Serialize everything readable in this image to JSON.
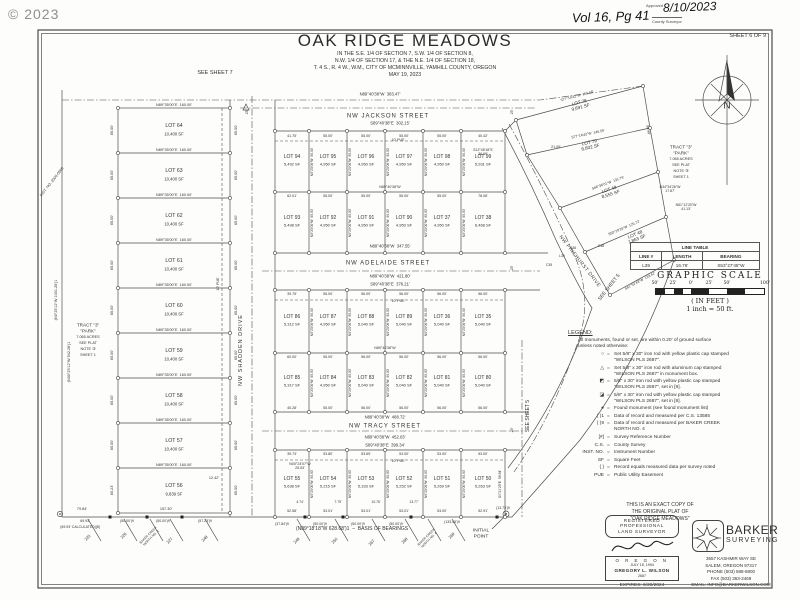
{
  "meta": {
    "copyright": "© 2023",
    "sheet": "SHEET 6 OF 9",
    "vol": "Vol 16, Pg 41",
    "approved_label": "Approved",
    "approved_date": "8/10/2023",
    "county": "County Surveyor"
  },
  "title": {
    "main": "OAK RIDGE MEADOWS",
    "sub1": "IN THE S.E. 1/4 OF SECTION 7, S.W. 1/4 OF SECTION 8,",
    "sub2": "N.W. 1/4 OF SECTION 17, & THE N.E. 1/4 OF SECTION 18,",
    "sub3": "T. 4 S., R. 4 W., W.M., CITY OF MCMINNVILLE, YAMHILL  COUNTY, OREGON",
    "date": "MAY 19, 2023"
  },
  "refs": {
    "see_sheet_7": "SEE SHEET 7",
    "see_sheet_5": "SEE SHEET 5",
    "north": "N"
  },
  "streets": {
    "jackson": "NW JACKSON STREET",
    "adelaide": "NW ADELAIDE STREET",
    "tracy": "NW TRACY STREET",
    "shadden": "NW SHADDEN DRIVE",
    "pinehurst": "NW PINEHURST DRIVE"
  },
  "left_column": {
    "divider_bearing": "N89°35'00\"E  160.00'",
    "side_dim": "65.00'",
    "pue": "10' PUE",
    "lots": [
      [
        "LOT 64",
        "10,400 SF"
      ],
      [
        "LOT 63",
        "10,400 SF"
      ],
      [
        "LOT 62",
        "10,400 SF"
      ],
      [
        "LOT 61",
        "10,400 SF"
      ],
      [
        "LOT 60",
        "10,400 SF"
      ],
      [
        "LOT 59",
        "10,400 SF"
      ],
      [
        "LOT 58",
        "10,400 SF"
      ],
      [
        "LOT 57",
        "10,400 SF"
      ],
      [
        "LOT 56",
        "9,839 SF"
      ]
    ],
    "edge_bearing1": "(N0°25'12\"W 1001.26')1",
    "edge_bearing2": "(N00°25'12\"W 942.28')1",
    "inst_no": "INST. NO. 2000-0966",
    "dim_1242": "12.42'",
    "dim_6023": "60.23'"
  },
  "tract": {
    "l1": "TRACT \"3\"",
    "l2": "\"PARK\"",
    "l3": "7.065 ACRES",
    "l4": "SEE PLAT",
    "l5": "NOTE ③",
    "l6": "SHEET 1"
  },
  "grid": {
    "vertical_dim": "N0°25'00\"W  90.00'",
    "right_dim": "S0°21'25\"E  99.94'",
    "pue": "10' PUE",
    "mid_bearing": "N89°40'38\"W",
    "rows": [
      {
        "lots": [
          [
            "LOT 94",
            "5,492 SF"
          ],
          [
            "LOT 95",
            "4,950 SF"
          ],
          [
            "LOT 96",
            "4,950 SF"
          ],
          [
            "LOT 97",
            "4,950 SF"
          ],
          [
            "LOT 98",
            "4,950 SF"
          ],
          [
            "LOT 99",
            "5,931 SF"
          ]
        ],
        "dims": [
          "41.75'",
          "55.00'",
          "55.00'",
          "55.00'",
          "55.00'",
          "40.42'"
        ]
      },
      {
        "lots": [
          [
            "LOT 93",
            "5,498 SF"
          ],
          [
            "LOT 92",
            "4,950 SF"
          ],
          [
            "LOT 91",
            "4,950 SF"
          ],
          [
            "LOT 90",
            "4,950 SF"
          ],
          [
            "LOT 37",
            "4,950 SF"
          ],
          [
            "LOT 38",
            "6,468 SF"
          ]
        ],
        "dims": [
          "62.01'",
          "55.00'",
          "55.00'",
          "55.00'",
          "55.00'",
          "78.08'"
        ]
      },
      {
        "lots": [
          [
            "LOT 86",
            "5,312 SF"
          ],
          [
            "LOT 87",
            "4,950 SF"
          ],
          [
            "LOT 88",
            "5,040 SF"
          ],
          [
            "LOT 89",
            "5,040 SF"
          ],
          [
            "LOT 36",
            "5,040 SF"
          ],
          [
            "LOT 35",
            "5,040 SF"
          ]
        ],
        "dims": [
          "39.75'",
          "55.00'",
          "56.00'",
          "56.00'",
          "56.00'",
          "56.00'"
        ]
      },
      {
        "lots": [
          [
            "LOT 85",
            "5,317 SF"
          ],
          [
            "LOT 84",
            "4,950 SF"
          ],
          [
            "LOT 83",
            "5,040 SF"
          ],
          [
            "LOT 82",
            "5,040 SF"
          ],
          [
            "LOT 81",
            "5,040 SF"
          ],
          [
            "LOT 80",
            "5,040 SF"
          ]
        ],
        "dims": [
          "60.00'",
          "55.00'",
          "56.00'",
          "56.00'",
          "56.00'",
          "56.00'"
        ],
        "bottom_dims": [
          "40.28'",
          "55.00'",
          "56.00'",
          "56.00'",
          "56.00'",
          "56.00'"
        ]
      },
      {
        "lots": [
          [
            "LOT 55",
            "5,638 SF"
          ],
          [
            "LOT 54",
            "5,215 SF"
          ],
          [
            "LOT 53",
            "5,333 SF"
          ],
          [
            "LOT 52",
            "5,252 SF"
          ],
          [
            "LOT 51",
            "5,269 SF"
          ],
          [
            "LOT 50",
            "5,263 SF"
          ]
        ],
        "dims": [
          "39.73'",
          "53.80'",
          "53.65'",
          "53.00'",
          "53.00'",
          "53.00'"
        ],
        "bottom_dims": [
          "52.58'",
          "53.01'",
          "53.01'",
          "53.01'",
          "53.00'",
          "52.91'"
        ]
      }
    ]
  },
  "street_dims": {
    "jackson_n": "N89°40'38\"W  383.47'",
    "jackson_s": "S89°40'38\"E  302.15'",
    "adelaide_n": "N89°40'38\"W  347.55'",
    "adelaide_s1": "N89°40'38\"W  421.80'",
    "adelaide_s2": "S89°40'38\"E  376.21'",
    "tracy_n": "N89°40'38\"W  488.72'",
    "tracy_s1": "N89°40'38\"W  452.03'",
    "tracy_s2": "S89°40'38\"E  399.34'",
    "half_width": "25'"
  },
  "right_side": {
    "lots": [
      [
        "LOT 78",
        "9,691 SF"
      ],
      [
        "LOT 79",
        "8,802 SF"
      ],
      [
        "LOT 49",
        "8,555 SF"
      ],
      [
        "LOT 48",
        "7,863 SF"
      ]
    ],
    "bearings": [
      "S77°14'42\"W  152.58'",
      "S77°14'42\"W  145.59'",
      "S66°36'01\"W  131.79'",
      "S50°29'26\"W  125.72'",
      "S61°52'43\"W  133.42'"
    ],
    "jog1": "N34°34'26\"W\n17.87'",
    "jog2": "N51°12'20\"W\n41.13'",
    "dim_2105": "21.05'",
    "dim_5449": "54.49'",
    "corner_bearing": "S12°45'18\"E\n36.99'",
    "curves": [
      "C35",
      "L39",
      "C36",
      "C38"
    ]
  },
  "bottom": {
    "basis": "(N89°18'18\"W 628.68')1  –  BASIS OF BEARINGS",
    "initial_point": "INITIAL\nPOINT",
    "offset_note": "N00°24'07\"W\n25.53'",
    "above_left": [
      "79.84'",
      "157.30'"
    ],
    "below_left": [
      "69.93'",
      "(69.93' CALCULATED)[8]",
      "(50.00')9",
      "(50.00')9",
      "(57.23')9"
    ],
    "below_mid": [
      "(37.84')9",
      "(50.00')9",
      "(50.00')9",
      "(50.00')9",
      "(133.45')9",
      "(13.73')9"
    ],
    "offsets": [
      "4.74'",
      "7.75'",
      "10.76'",
      "13.77'"
    ],
    "adjacent": [
      "225",
      "226",
      "227",
      "248",
      "249",
      "250",
      "267",
      "268",
      "269"
    ],
    "sub1": "BAKER CREEK\nNORTH NO. 3",
    "sub2": "BAKER CREEK\nNORTH NO. 4"
  },
  "line_table": {
    "title": "LINE TABLE",
    "h1": "LINE #",
    "h2": "LENGTH",
    "h3": "BEARING",
    "r1c1": "L39",
    "r1c2": "16.76'",
    "r1c3": "S53°27'45\"W"
  },
  "scale": {
    "title": "GRAPHIC SCALE",
    "t1": "50'",
    "t2": "25'",
    "t3": "0'",
    "t4": "25'",
    "t5": "50'",
    "t6": "100'",
    "unit": "( IN FEET )",
    "eq": "1 inch = 50 ft."
  },
  "legend": {
    "title": "LEGEND:",
    "intro1": "All monuments, found or set, are within 0.20' of ground surface",
    "intro2": "unless noted otherwise:",
    "items": [
      {
        "sym": "○",
        "t1": "Set 5/8\" x 30\" iron rod with yellow plastic cap stamped",
        "t2": "\"WILSON PLS 2687\"."
      },
      {
        "sym": "△",
        "t1": "Set 5/8\" x 30\" iron rod with aluminum cap stamped",
        "t2": "\"WILSON PLS 2687\" in monument box."
      },
      {
        "sym": "◩",
        "t1": "5/8\" x 30\" iron rod with yellow plastic cap stamped",
        "t2": "\"WILSON PLS 2687\", set in [9]."
      },
      {
        "sym": "◪",
        "t1": "5/8\" x 30\" iron rod with yellow plastic cap stamped",
        "t2": "\"WILSON PLS 2687\", set in [8]."
      },
      {
        "sym": "●",
        "t1": "Found monument (see found monument list)",
        "t2": ""
      },
      {
        "sym": "(  )1",
        "t1": "Data of record and measured per C.S. 13585",
        "t2": ""
      },
      {
        "sym": "(  )9",
        "t1": "Data of record and measured per BAKER CREEK",
        "t2": "NORTH NO. 4"
      },
      {
        "sym": "[#]",
        "t1": "Survey Reference Number",
        "t2": ""
      },
      {
        "sym": "C.S.",
        "t1": "County Survey",
        "t2": ""
      },
      {
        "sym": "INST. NO.",
        "t1": "Instrument Number",
        "t2": ""
      },
      {
        "sym": "SF",
        "t1": "Square Feet",
        "t2": ""
      },
      {
        "sym": "{  }",
        "t1": "Record equals measured data per survey noted",
        "t2": ""
      },
      {
        "sym": "PUE",
        "t1": "Public Utility Easement",
        "t2": ""
      }
    ]
  },
  "copy_note": {
    "l1": "THIS IS AN EXACT COPY OF",
    "l2": "THE ORIGINAL PLAT OF",
    "l3": "\"OAK RIDGE MEADOWS\""
  },
  "stamp": {
    "l1": "REGISTERED",
    "l2": "PROFESSIONAL",
    "l3": "LAND  SURVEYOR",
    "state": "O R E G O N",
    "date": "JULY 18, 1994",
    "name": "GREGORY L. WILSON",
    "num": "2687",
    "expires": "EXPIRES: 6/30/2024"
  },
  "firm": {
    "name": "BARKER",
    "tag": "SURVEYING",
    "a1": "3657 KASHMIR WAY SE",
    "a2": "SALEM, OREGON 97317",
    "a3": "PHONE (503) 588-8800",
    "a4": "FAX  (503) 363-2469",
    "a5": "EMAIL: INFO@BARKERWILSON.COM"
  }
}
